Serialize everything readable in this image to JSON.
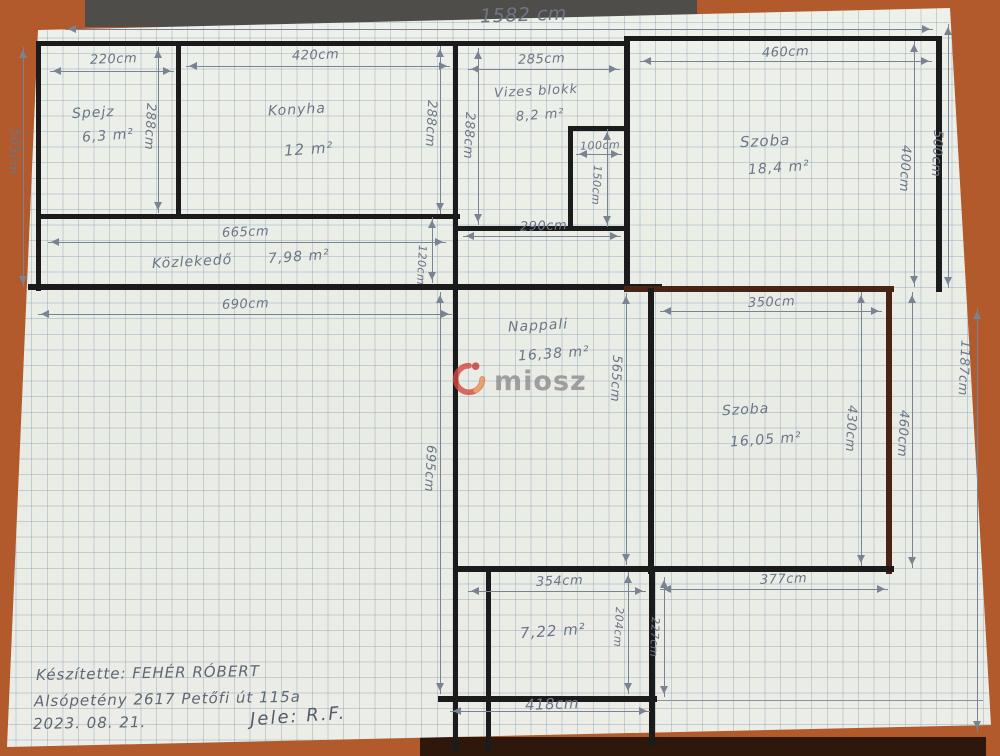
{
  "rooms": [
    {
      "name": "Spejz",
      "area": "6,3 m²"
    },
    {
      "name": "Konyha",
      "area": "12 m²"
    },
    {
      "name": "Vizes blokk",
      "area": "8,2 m²"
    },
    {
      "name": "Szoba",
      "area": "18,4 m²"
    },
    {
      "name": "Közlekedő",
      "area": "7,98 m²"
    },
    {
      "name": "Nappali",
      "area": "16,38 m²"
    },
    {
      "name": "Szoba",
      "area": "16,05 m²"
    },
    {
      "name": "",
      "area": "7,22 m²"
    }
  ],
  "dims": {
    "total_top": "1582 cm",
    "spejz_w": "220cm",
    "konyha_w": "420cm",
    "vizes_w": "285cm",
    "szoba1_w": "460cm",
    "hall_inner_w": "665cm",
    "hall_outer_w": "690cm",
    "nappali_w": "290cm",
    "closet_w": "100cm",
    "closet_h": "150cm",
    "szoba2_w": "350cm",
    "room722_w": "354cm",
    "bottom_right_w": "377cm",
    "bottom_w": "418cm",
    "left_h": "505cm",
    "row_h_a": "288cm",
    "row_h_b": "288cm",
    "row_h_c": "288cm",
    "hall_h": "120cm",
    "nappali_h": "565cm",
    "left_lower_h": "695cm",
    "szoba1_h": "400cm",
    "right_top_h": "500cm",
    "right_total_h": "1187cm",
    "szoba2_h": "430cm",
    "szoba2_right_h": "460cm",
    "room722_h": "204cm",
    "bottom_right_h": "227cm"
  },
  "footer": {
    "made_by": "Készítette: FEHÉR RÓBERT",
    "address": "Alsópetény 2617 Petőfi út 115a",
    "date": "2023. 08. 21.",
    "signature": "Jele: R.F."
  },
  "logo": {
    "text": "miosz"
  }
}
